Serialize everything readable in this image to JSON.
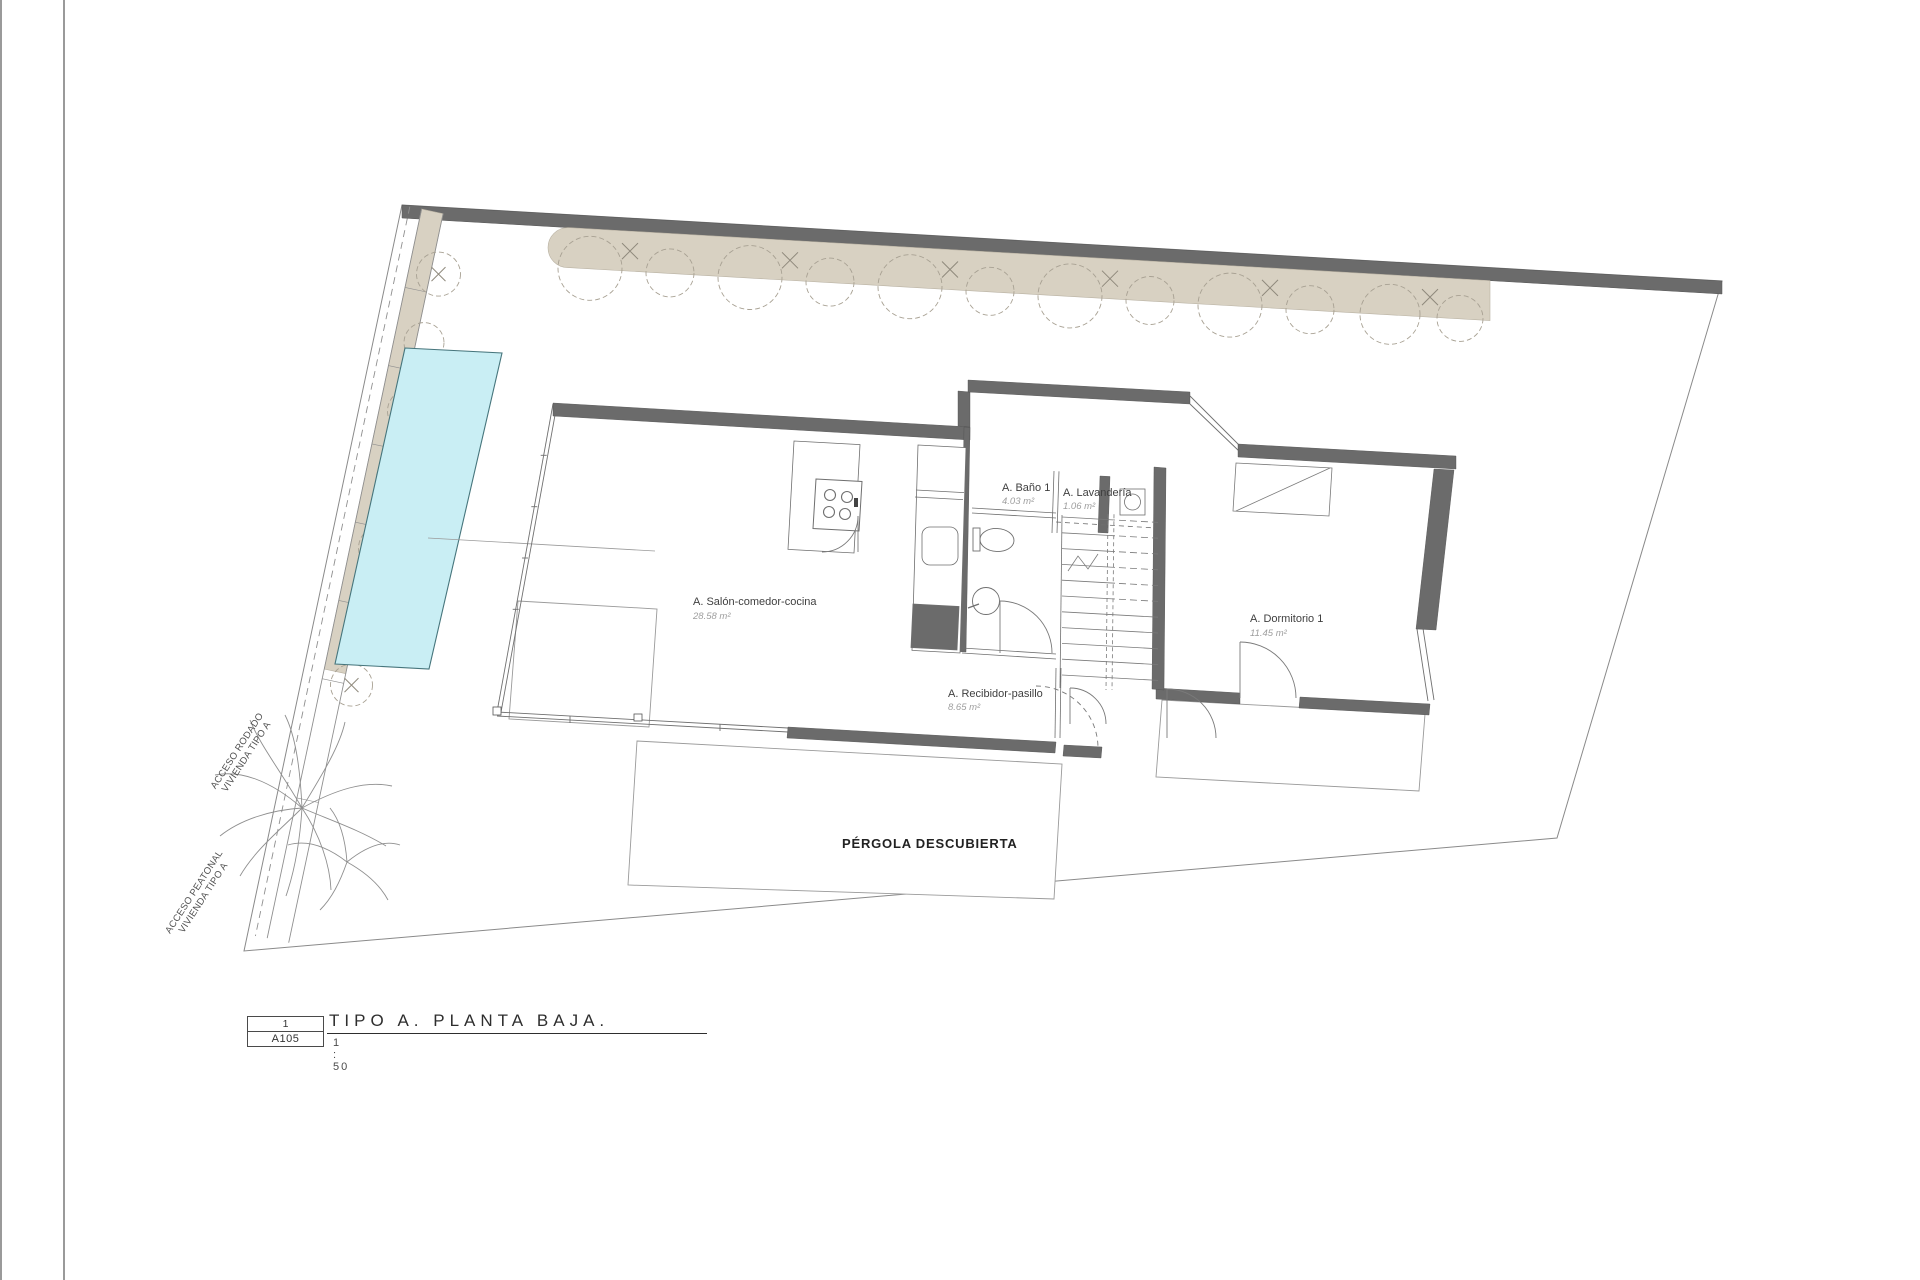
{
  "drawing": {
    "rooms": [
      {
        "name": "A. Salón-comedor-cocina",
        "area": "28.58 m²"
      },
      {
        "name": "A. Baño 1",
        "area": "4.03 m²"
      },
      {
        "name": "A. Lavandería",
        "area": "1.06 m²"
      },
      {
        "name": "A. Dormitorio 1",
        "area": "11.45 m²"
      },
      {
        "name": "A. Recibidor-pasillo",
        "area": "8.65 m²"
      }
    ],
    "outdoor": {
      "pergola_label": "PÉRGOLA DESCUBIERTA",
      "access_road_line1": "ACCESO RODADO",
      "access_road_line2": "VIVIENDA TIPO A",
      "access_pedestrian_line1": "ACCESO PEATONAL",
      "access_pedestrian_line2": "VIVIENDA TIPO A"
    }
  },
  "title_block": {
    "detail_number": "1",
    "sheet_code": "A105",
    "title": "TIPO A. PLANTA BAJA.",
    "scale": "1 : 50"
  },
  "colors": {
    "wall": "#6b6b6b",
    "landscape_tan": "#d8d1c2",
    "pool_fill": "#c9eef4",
    "pool_border": "#46757c",
    "thin_line": "#8c8c8c",
    "label_text": "#3f3f3f",
    "area_text": "#9e9e9e"
  }
}
